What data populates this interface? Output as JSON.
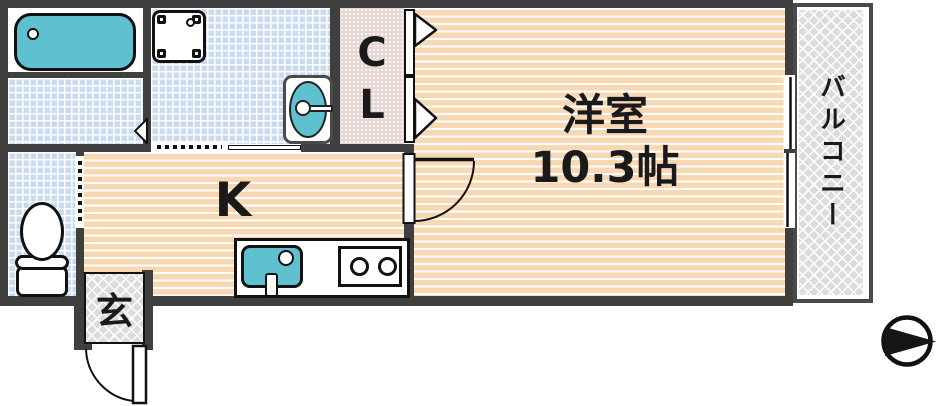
{
  "plan": {
    "type": "apartment-floor-plan",
    "rooms": {
      "western": {
        "name": "洋室",
        "size": "10.3帖"
      },
      "kitchen": {
        "label": "K"
      },
      "closet": {
        "label": "CL"
      },
      "entrance": {
        "label": "玄"
      },
      "balcony": {
        "label": "バルコニー"
      }
    },
    "compass": {
      "points": "right"
    },
    "colors": {
      "wall": "#3f3f3f",
      "water_fixture": "#5fc0cf",
      "wood_floor": "#f8d7b3",
      "tile": "#c9daf1",
      "closet_fill": "#e9d5d1",
      "outdoor_hatch": "#dcdcdc"
    }
  }
}
